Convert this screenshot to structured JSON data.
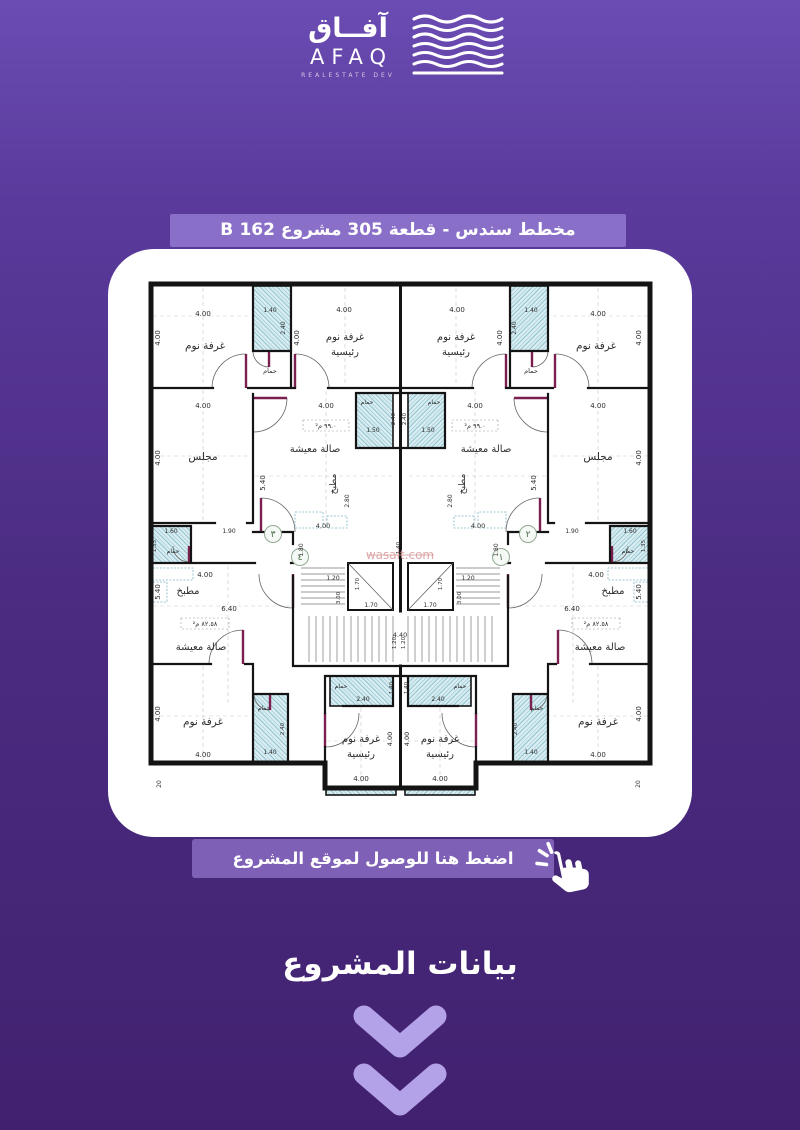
{
  "colors": {
    "bg_top": "#6a4cb3",
    "bg_bottom": "#41216f",
    "banner": "#8a6fc9",
    "cta": "#7e61b7",
    "chevron": "#b4a2e9",
    "card": "#ffffff",
    "wall": "#141414",
    "hatch_fill": "#d9ecf1",
    "door_leaf": "#7a1f4f",
    "watermark": "#d89a9a"
  },
  "header": {
    "logo": {
      "arabic": "آفــاق",
      "latin": "AFAQ",
      "subtitle": "REALESTATE DEV"
    },
    "title": "مخطط سندس - قطعة 305   مشروع 162 B"
  },
  "cta": {
    "label": "اضغط هنا للوصول لموقع المشروع"
  },
  "footer": {
    "title": "بيانات المشروع"
  },
  "plan": {
    "watermark": "wasalt.com",
    "units": [
      {
        "x": 130,
        "y": 258,
        "t": "٣"
      },
      {
        "x": 157,
        "y": 281,
        "t": "٤"
      },
      {
        "x": 385,
        "y": 258,
        "t": "٢"
      },
      {
        "x": 358,
        "y": 281,
        "t": "١"
      }
    ],
    "labels": [
      {
        "x": 60,
        "y": 40,
        "t": "4.00",
        "s": 7,
        "m": 1
      },
      {
        "x": 17,
        "y": 62,
        "t": "4.00",
        "s": 7,
        "r": -90,
        "m": 1
      },
      {
        "x": 62,
        "y": 73,
        "t": "غرفة نوم",
        "s": 10.5,
        "m": 1
      },
      {
        "x": 127,
        "y": 36,
        "t": "1.40",
        "s": 6,
        "m": 1
      },
      {
        "x": 142,
        "y": 52,
        "t": "2.40",
        "s": 6,
        "r": -90,
        "m": 1
      },
      {
        "x": 127,
        "y": 97,
        "t": "حمام",
        "s": 6.5,
        "m": 1
      },
      {
        "x": 201,
        "y": 36,
        "t": "4.00",
        "s": 7,
        "m": 1
      },
      {
        "x": 156,
        "y": 62,
        "t": "4.00",
        "s": 7,
        "r": -90,
        "m": 1
      },
      {
        "x": 202,
        "y": 64,
        "t": "غرفة نوم",
        "s": 10,
        "m": 1
      },
      {
        "x": 202,
        "y": 79,
        "t": "رئيسية",
        "s": 10,
        "m": 1
      },
      {
        "x": 60,
        "y": 132,
        "t": "4.00",
        "s": 7,
        "m": 1
      },
      {
        "x": 17,
        "y": 182,
        "t": "4.00",
        "s": 7,
        "r": -90,
        "m": 1
      },
      {
        "x": 60,
        "y": 184,
        "t": "مجلس",
        "s": 10.5,
        "m": 1
      },
      {
        "x": 183,
        "y": 132,
        "t": "4.00",
        "s": 7,
        "m": 1
      },
      {
        "x": 183,
        "y": 152,
        "t": "٩٩.٠ م²",
        "s": 6.5,
        "m": 1
      },
      {
        "x": 172,
        "y": 176,
        "t": "صالة معيشة",
        "s": 10,
        "m": 1
      },
      {
        "x": 122,
        "y": 207,
        "t": "5.40",
        "s": 7,
        "r": -90,
        "m": 1
      },
      {
        "x": 224,
        "y": 128,
        "t": "حمام",
        "s": 6,
        "m": 1
      },
      {
        "x": 230,
        "y": 156,
        "t": "1.50",
        "s": 6,
        "m": 1
      },
      {
        "x": 252,
        "y": 143,
        "t": "2.40",
        "s": 5.5,
        "r": -90,
        "m": 1
      },
      {
        "x": 193,
        "y": 208,
        "t": "مطبخ",
        "s": 9,
        "r": -90,
        "m": 1
      },
      {
        "x": 206,
        "y": 225,
        "t": "2.80",
        "s": 6,
        "r": -90,
        "m": 1
      },
      {
        "x": 180,
        "y": 252,
        "t": "4.00",
        "s": 6.5,
        "m": 1
      },
      {
        "x": 28,
        "y": 257,
        "t": "1.60",
        "s": 6,
        "m": 1
      },
      {
        "x": 13,
        "y": 270,
        "t": "1.35",
        "s": 5.5,
        "r": -90,
        "m": 1
      },
      {
        "x": 30,
        "y": 277,
        "t": "حمام",
        "s": 6,
        "m": 1
      },
      {
        "x": 86,
        "y": 257,
        "t": "1.90",
        "s": 6,
        "m": 1
      },
      {
        "x": 160,
        "y": 274,
        "t": "1.80",
        "s": 6,
        "r": -90,
        "m": 1
      },
      {
        "x": 62,
        "y": 301,
        "t": "4.00",
        "s": 7,
        "m": 1
      },
      {
        "x": 45,
        "y": 318,
        "t": "مطبخ",
        "s": 10,
        "m": 1
      },
      {
        "x": 17,
        "y": 316,
        "t": "5.40",
        "s": 7,
        "r": -90,
        "m": 1
      },
      {
        "x": 86,
        "y": 335,
        "t": "6.40",
        "s": 7,
        "m": 1
      },
      {
        "x": 62,
        "y": 350,
        "t": "٨٢.٥٨ م²",
        "s": 6.5,
        "m": 1
      },
      {
        "x": 58,
        "y": 374,
        "t": "صالة معيشة",
        "s": 10,
        "m": 1
      },
      {
        "x": 17,
        "y": 438,
        "t": "4.00",
        "s": 7,
        "r": -90,
        "m": 1
      },
      {
        "x": 60,
        "y": 449,
        "t": "غرفة نوم",
        "s": 10.5,
        "m": 1
      },
      {
        "x": 60,
        "y": 481,
        "t": "4.00",
        "s": 7,
        "m": 1
      },
      {
        "x": 121,
        "y": 434,
        "t": "حمام",
        "s": 6,
        "m": 1
      },
      {
        "x": 127,
        "y": 478,
        "t": "1.40",
        "s": 6,
        "m": 1
      },
      {
        "x": 141,
        "y": 453,
        "t": "2.40",
        "s": 5.5,
        "r": -90,
        "m": 1
      },
      {
        "x": 198,
        "y": 412,
        "t": "حمام",
        "s": 6,
        "m": 1
      },
      {
        "x": 220,
        "y": 425,
        "t": "2.40",
        "s": 6,
        "m": 1
      },
      {
        "x": 250,
        "y": 412,
        "t": "1.40",
        "s": 5.5,
        "r": -90,
        "m": 1
      },
      {
        "x": 218,
        "y": 466,
        "t": "غرفة نوم",
        "s": 10,
        "m": 1
      },
      {
        "x": 218,
        "y": 481,
        "t": "رئيسية",
        "s": 10,
        "m": 1
      },
      {
        "x": 218,
        "y": 505,
        "t": "4.00",
        "s": 7,
        "m": 1
      },
      {
        "x": 249,
        "y": 463,
        "t": "4.00",
        "s": 6.5,
        "r": -90,
        "m": 1
      },
      {
        "x": 18,
        "y": 508,
        "t": "20",
        "s": 6,
        "r": -90,
        "m": 1
      },
      {
        "x": 257,
        "y": 272,
        "t": "1.40",
        "s": 5.5,
        "r": -90
      },
      {
        "x": 190,
        "y": 304,
        "t": "1.20",
        "s": 6,
        "m": 1
      },
      {
        "x": 197,
        "y": 322,
        "t": "3.00",
        "s": 5.5,
        "r": -90,
        "m": 1
      },
      {
        "x": 216,
        "y": 308,
        "t": "1.70",
        "s": 5.5,
        "r": -90,
        "m": 1
      },
      {
        "x": 228,
        "y": 331,
        "t": "1.70",
        "s": 6,
        "m": 1
      },
      {
        "x": 253,
        "y": 367,
        "t": "1.20",
        "s": 5.5,
        "r": -90,
        "m": 1
      },
      {
        "x": 257,
        "y": 361,
        "t": "4.40",
        "s": 6.5
      }
    ]
  }
}
